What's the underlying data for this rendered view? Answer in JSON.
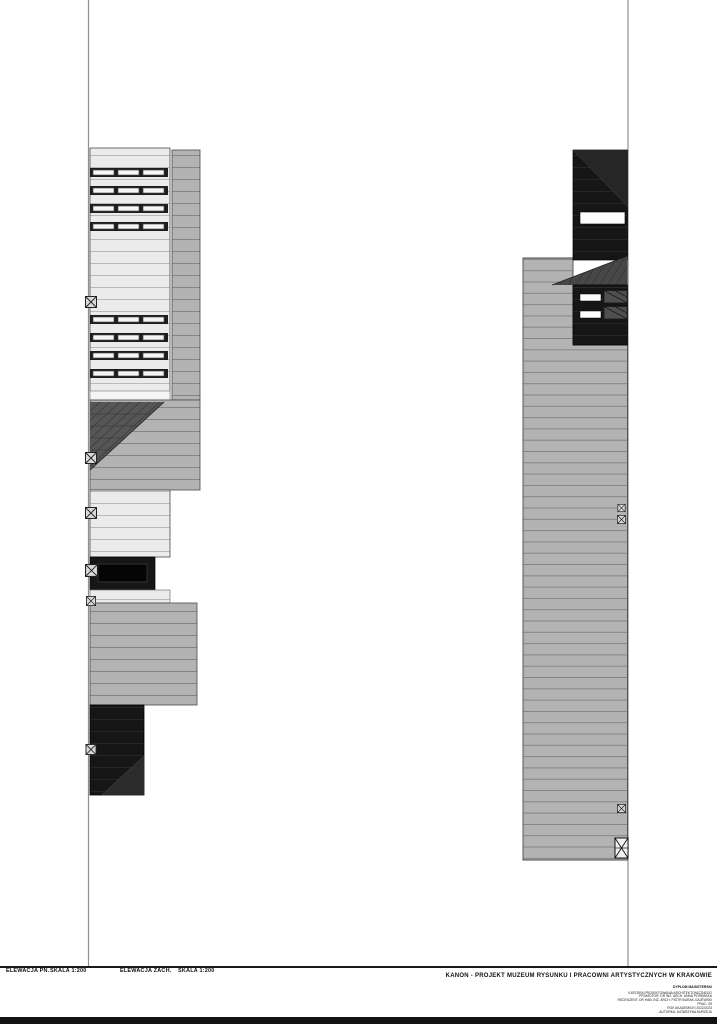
{
  "sheet": {
    "footer": {
      "views": [
        {
          "name": "ELEWACJA PN.",
          "scale": "SKALA 1:200"
        },
        {
          "name": "ELEWACJA ZACH.",
          "scale": "SKALA 1:200"
        }
      ]
    },
    "title_block": {
      "project_title": "KANON - PROJEKT MUZEUM RYSUNKU I PRACOWNI ARTYSTYCZNYCH W KRAKOWIE",
      "subtitle": "DYPLOM MAGISTERSKI",
      "credits": [
        "KATEDRA PROJEKTOWANIA ARCHITEKTONICZNEGO",
        "PROMOTOR: DR INŻ. ARCH. ANNA PORĘBSKA",
        "RECENZENT: DR HAB. INŻ. ARCH. PIOTR BURAK-GAJEWSKI",
        "PRAC. 09",
        "ROK AKADEMICKI 2022/2023",
        "AUTORKA: KATARZYNA KURZEJA"
      ]
    },
    "markers": {
      "type": "crossed-box detail marker"
    }
  },
  "colors": {
    "paper": "#ffffff",
    "frame-line": "#8f8f8f",
    "facade-light": "#ebebeb",
    "facade-light-line": "#a8a8a8",
    "gray-block": "#b3b3b3",
    "gray-line": "#848484",
    "dark-triangle": "#565656",
    "roof-dark": "#474747",
    "black-block": "#161616",
    "black-line": "#2b2b2b",
    "window-frame": "#1d1d1d",
    "window-pane": "#f6f6f6",
    "marker-bg": "#d9d9d9",
    "marker-line": "#222222",
    "outline": "#4a4a4a"
  }
}
